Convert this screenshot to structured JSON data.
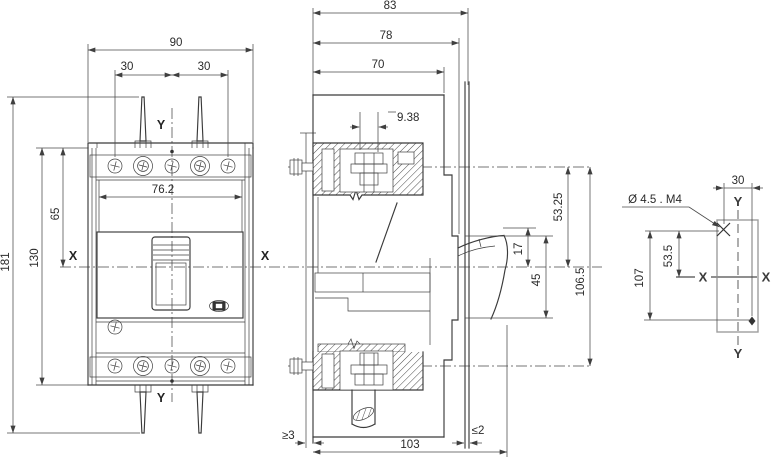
{
  "views": {
    "front": {
      "dims": {
        "overall_width": "90",
        "pole_pitch_left": "30",
        "pole_pitch_right": "30",
        "window_width": "76.2",
        "top_to_x": "65",
        "body_height": "130",
        "overall_height": "181"
      },
      "axes": {
        "y_top": "Y",
        "y_bottom": "Y",
        "x_left": "X",
        "x_right": "X"
      }
    },
    "side": {
      "dims": {
        "depth_83": "83",
        "depth_78": "78",
        "depth_70": "70",
        "offset_938": "9.38",
        "axis_to_x": "53.25",
        "window_top_to_x": "17",
        "window_height": "45",
        "terminal_pitch": "106.5",
        "depth_overall": "103",
        "clearance_min": "≥3",
        "panel_max": "≤2"
      }
    },
    "mount": {
      "hole_callout": "Ø 4.5 . M4",
      "dims": {
        "hole_offset_x": "30",
        "hole_to_x": "53.5",
        "hole_pitch": "107"
      },
      "axes": {
        "y_top": "Y",
        "y_bottom": "Y",
        "x_left": "X",
        "x_right": "X"
      }
    }
  }
}
